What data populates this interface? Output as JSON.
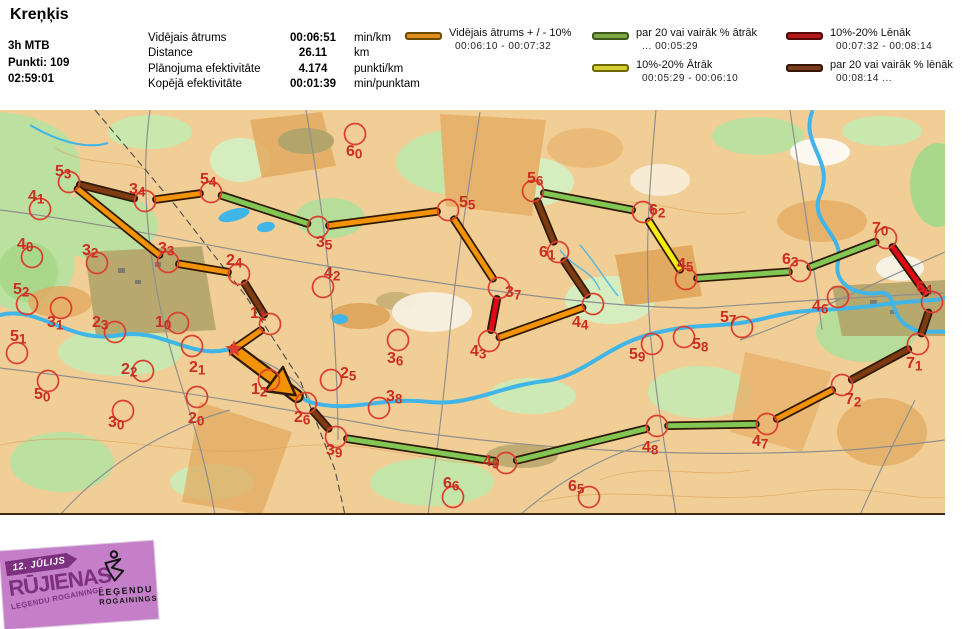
{
  "header": {
    "title": "Kreņķis",
    "class_name": "3h MTB",
    "points": "Punkti: 109",
    "time": "02:59:01",
    "stats": [
      {
        "label": "Vidējais ātrums",
        "value": "00:06:51",
        "unit": "min/km"
      },
      {
        "label": "Distance",
        "value": "26.11",
        "unit": "km"
      },
      {
        "label": "Plānojuma efektivitāte",
        "value": "4.174",
        "unit": "punkti/km"
      },
      {
        "label": "Kopējā efektivitāte",
        "value": "00:01:39",
        "unit": "min/punktam"
      }
    ]
  },
  "legend": {
    "items": [
      {
        "key": "avg",
        "label": "Vidējais ātrums + / - 10%",
        "range": "00:06:10   -   00:07:32",
        "color": "#E0901F",
        "border": "#6E4A00"
      },
      {
        "key": "fast20",
        "label": "par 20 vai vairāk % ātrāk",
        "range": "...    00:05:29",
        "color": "#7FA844",
        "border": "#3C5A1A"
      },
      {
        "key": "fast10",
        "label": "10%-20% Ātrāk",
        "range": "00:05:29   -   00:06:10",
        "color": "#D5CE35",
        "border": "#6E6A00"
      },
      {
        "key": "slow10",
        "label": "10%-20% Lēnāk",
        "range": "00:07:32   -  00:08:14",
        "color": "#B51A1A",
        "border": "#560909"
      },
      {
        "key": "slow20",
        "label": "par 20 vai vairāk % lēnāk",
        "range": "00:08:14   ...",
        "color": "#7B3C1E",
        "border": "#351505"
      }
    ]
  },
  "map": {
    "speed_colors": {
      "avg": "#F39204",
      "fast20": "#82C654",
      "fast10": "#F6EB0C",
      "slow10": "#E30615",
      "slow20": "#7E3B12"
    },
    "route_outline": "#2F1B05",
    "control_color": "#DC3D2C",
    "label_color": "#CC2D22",
    "start": {
      "x": 234,
      "y": 349
    },
    "controls": [
      {
        "id": "53",
        "cx": 69,
        "cy": 182,
        "lx": 55,
        "ly": 176
      },
      {
        "id": "41",
        "cx": 40,
        "cy": 209,
        "lx": 28,
        "ly": 201
      },
      {
        "id": "34",
        "cx": 145,
        "cy": 201,
        "lx": 129,
        "ly": 194
      },
      {
        "id": "54",
        "cx": 211,
        "cy": 192,
        "lx": 200,
        "ly": 184
      },
      {
        "id": "33",
        "cx": 168,
        "cy": 262,
        "lx": 158,
        "ly": 253
      },
      {
        "id": "24",
        "cx": 239,
        "cy": 274,
        "lx": 226,
        "ly": 265
      },
      {
        "id": "40",
        "cx": 32,
        "cy": 257,
        "lx": 17,
        "ly": 249
      },
      {
        "id": "32",
        "cx": 97,
        "cy": 263,
        "lx": 82,
        "ly": 255
      },
      {
        "id": "52",
        "cx": 27,
        "cy": 304,
        "lx": 13,
        "ly": 294
      },
      {
        "id": "31",
        "cx": 61,
        "cy": 308,
        "lx": 47,
        "ly": 327
      },
      {
        "id": "23",
        "cx": 115,
        "cy": 332,
        "lx": 92,
        "ly": 327
      },
      {
        "id": "10",
        "cx": 178,
        "cy": 323,
        "lx": 155,
        "ly": 327
      },
      {
        "id": "51",
        "cx": 17,
        "cy": 353,
        "lx": 10,
        "ly": 341
      },
      {
        "id": "21",
        "cx": 192,
        "cy": 346,
        "lx": 189,
        "ly": 372
      },
      {
        "id": "22",
        "cx": 143,
        "cy": 371,
        "lx": 121,
        "ly": 374
      },
      {
        "id": "50",
        "cx": 48,
        "cy": 381,
        "lx": 34,
        "ly": 399
      },
      {
        "id": "30",
        "cx": 123,
        "cy": 411,
        "lx": 108,
        "ly": 427
      },
      {
        "id": "20",
        "cx": 197,
        "cy": 397,
        "lx": 188,
        "ly": 423
      },
      {
        "id": "12",
        "cx": 269,
        "cy": 380,
        "lx": 251,
        "ly": 394
      },
      {
        "id": "11",
        "cx": 270,
        "cy": 324,
        "lx": 250,
        "ly": 318
      },
      {
        "id": "26",
        "cx": 306,
        "cy": 403,
        "lx": 294,
        "ly": 422
      },
      {
        "id": "39",
        "cx": 336,
        "cy": 437,
        "lx": 326,
        "ly": 455
      },
      {
        "id": "25",
        "cx": 331,
        "cy": 380,
        "lx": 340,
        "ly": 378
      },
      {
        "id": "38",
        "cx": 379,
        "cy": 408,
        "lx": 386,
        "ly": 401
      },
      {
        "id": "36",
        "cx": 398,
        "cy": 340,
        "lx": 387,
        "ly": 363
      },
      {
        "id": "42",
        "cx": 323,
        "cy": 287,
        "lx": 324,
        "ly": 278
      },
      {
        "id": "60",
        "cx": 355,
        "cy": 134,
        "lx": 346,
        "ly": 156
      },
      {
        "id": "66",
        "cx": 453,
        "cy": 497,
        "lx": 443,
        "ly": 488
      },
      {
        "id": "65",
        "cx": 589,
        "cy": 497,
        "lx": 568,
        "ly": 491
      },
      {
        "id": "49",
        "cx": 506,
        "cy": 463,
        "lx": 483,
        "ly": 466
      },
      {
        "id": "43",
        "cx": 489,
        "cy": 341,
        "lx": 470,
        "ly": 356
      },
      {
        "id": "44",
        "cx": 593,
        "cy": 304,
        "lx": 572,
        "ly": 327
      },
      {
        "id": "37",
        "cx": 499,
        "cy": 288,
        "lx": 505,
        "ly": 297
      },
      {
        "id": "55",
        "cx": 448,
        "cy": 210,
        "lx": 459,
        "ly": 207
      },
      {
        "id": "35",
        "cx": 318,
        "cy": 227,
        "lx": 316,
        "ly": 247
      },
      {
        "id": "61",
        "cx": 558,
        "cy": 252,
        "lx": 539,
        "ly": 257
      },
      {
        "id": "56",
        "cx": 533,
        "cy": 191,
        "lx": 527,
        "ly": 183
      },
      {
        "id": "62",
        "cx": 643,
        "cy": 212,
        "lx": 649,
        "ly": 215
      },
      {
        "id": "45",
        "cx": 686,
        "cy": 279,
        "lx": 677,
        "ly": 269
      },
      {
        "id": "63",
        "cx": 800,
        "cy": 271,
        "lx": 782,
        "ly": 264
      },
      {
        "id": "70",
        "cx": 886,
        "cy": 238,
        "lx": 872,
        "ly": 233
      },
      {
        "id": "64",
        "cx": 932,
        "cy": 302,
        "lx": 916,
        "ly": 292
      },
      {
        "id": "71",
        "cx": 918,
        "cy": 344,
        "lx": 906,
        "ly": 368
      },
      {
        "id": "72",
        "cx": 842,
        "cy": 385,
        "lx": 845,
        "ly": 404
      },
      {
        "id": "47",
        "cx": 767,
        "cy": 424,
        "lx": 752,
        "ly": 446
      },
      {
        "id": "48",
        "cx": 657,
        "cy": 426,
        "lx": 642,
        "ly": 452
      },
      {
        "id": "59",
        "cx": 652,
        "cy": 344,
        "lx": 629,
        "ly": 359
      },
      {
        "id": "58",
        "cx": 684,
        "cy": 337,
        "lx": 692,
        "ly": 349
      },
      {
        "id": "57",
        "cx": 742,
        "cy": 327,
        "lx": 720,
        "ly": 322
      },
      {
        "id": "46",
        "cx": 838,
        "cy": 297,
        "lx": 812,
        "ly": 311
      }
    ],
    "route": [
      {
        "a": "start",
        "b": "26",
        "s": "avg",
        "arrow": true
      },
      {
        "a": "26",
        "b": "39",
        "s": "slow20"
      },
      {
        "a": "39",
        "b": "49",
        "s": "fast20"
      },
      {
        "a": "49",
        "b": "48",
        "s": "fast20"
      },
      {
        "a": "48",
        "b": "47",
        "s": "fast20"
      },
      {
        "a": "47",
        "b": "72",
        "s": "avg"
      },
      {
        "a": "72",
        "b": "71",
        "s": "slow20"
      },
      {
        "a": "71",
        "b": "64",
        "s": "slow20"
      },
      {
        "a": "64",
        "b": "70",
        "s": "slow10"
      },
      {
        "a": "70",
        "b": "63",
        "s": "fast20"
      },
      {
        "a": "63",
        "b": "45",
        "s": "fast20"
      },
      {
        "a": "45",
        "b": "62",
        "s": "fast10"
      },
      {
        "a": "62",
        "b": "56",
        "s": "fast20"
      },
      {
        "a": "56",
        "b": "61",
        "s": "slow20"
      },
      {
        "a": "61",
        "b": "44",
        "s": "slow20"
      },
      {
        "a": "44",
        "b": "43",
        "s": "avg"
      },
      {
        "a": "43",
        "b": "37",
        "s": "slow10"
      },
      {
        "a": "37",
        "b": "55",
        "s": "avg"
      },
      {
        "a": "55",
        "b": "35",
        "s": "avg"
      },
      {
        "a": "35",
        "b": "54",
        "s": "fast20"
      },
      {
        "a": "54",
        "b": "34",
        "s": "avg"
      },
      {
        "a": "34",
        "b": "53",
        "s": "slow20"
      },
      {
        "a": "53",
        "b": "33",
        "s": "avg"
      },
      {
        "a": "33",
        "b": "24",
        "s": "avg"
      },
      {
        "a": "24",
        "b": "11",
        "s": "slow20"
      },
      {
        "a": "11",
        "b": "start",
        "s": "avg"
      }
    ]
  },
  "logo": {
    "date": "12. JŪLIJS",
    "title": "RŪJIENAS",
    "subtitle": "LEĢENDU ROGAININGS",
    "brand_line1": "LEĢENDU",
    "brand_line2": "ROGAININGS"
  }
}
